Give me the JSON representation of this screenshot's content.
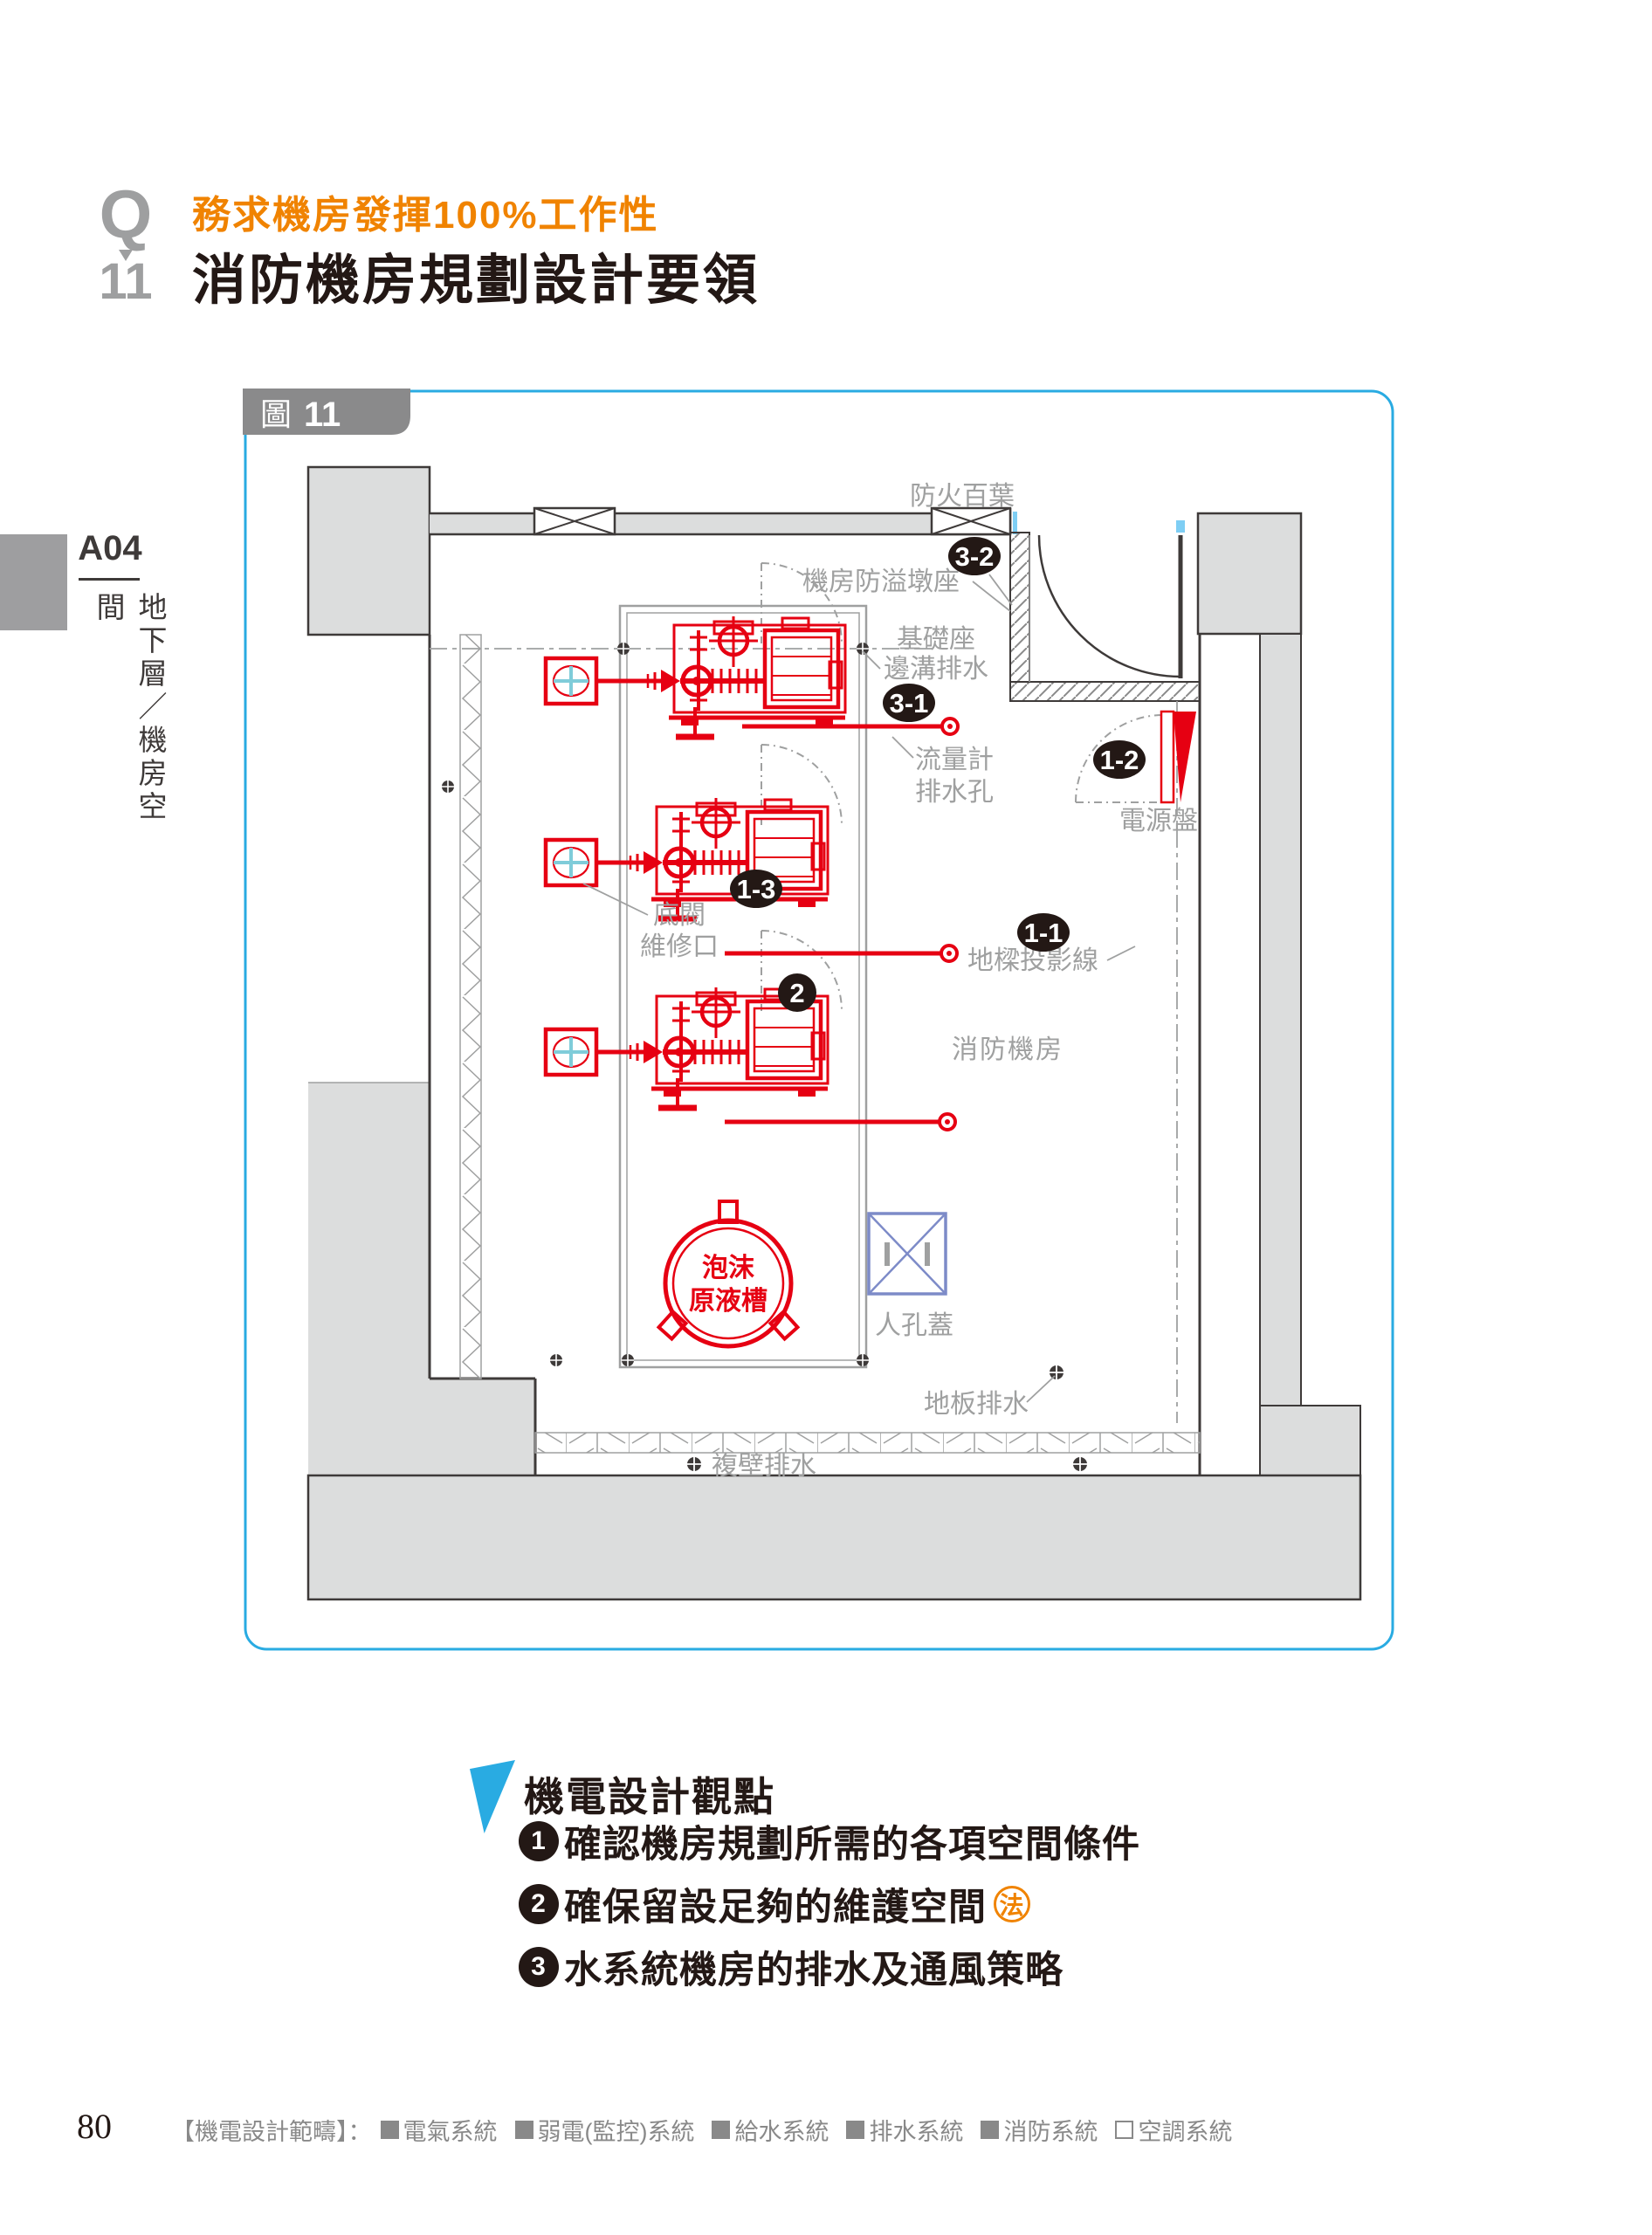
{
  "header": {
    "q_mark": "Q",
    "q_number": "11",
    "subtitle": "務求機房發揮100%工作性",
    "title": "消防機房規劃設計要領",
    "accent_orange": "#F08300"
  },
  "sidebar": {
    "code": "A04",
    "section": "地下層／機房空間"
  },
  "figure": {
    "tab_icon": "圖",
    "tab_number": "11",
    "border_color": "#29ABE2",
    "plan": {
      "labels": {
        "fire_louver": "防火百葉",
        "overflow_curb": "機房防溢墩座",
        "foundation1": "基礎座",
        "foundation2": "邊溝排水",
        "flow1": "流量計",
        "flow2": "排水孔",
        "power_panel": "電源盤",
        "beam_projection": "地樑投影線",
        "foot_valve1": "底閥",
        "foot_valve2": "維修口",
        "room_name": "消防機房",
        "tank1": "泡沫",
        "tank2": "原液槽",
        "manhole": "人孔蓋",
        "floor_drain": "地板排水",
        "wall_drain": "複壁排水"
      },
      "callouts": [
        "3-2",
        "3-1",
        "1-2",
        "1-3",
        "1-1",
        "2"
      ],
      "colors": {
        "equipment_red": "#E60012",
        "wall_dark": "#3E3A39",
        "fill_gray": "#DCDDDD",
        "label_gray": "#9FA0A0",
        "manhole_blue": "#7D8BC8",
        "valve_teal": "#7FCCD9"
      }
    }
  },
  "viewpoints": {
    "heading": "機電設計觀點",
    "law_mark": "法",
    "items": [
      {
        "num": "1",
        "text": "確認機房規劃所需的各項空間條件",
        "has_law_mark": false
      },
      {
        "num": "2",
        "text": "確保留設足夠的維護空間",
        "has_law_mark": true
      },
      {
        "num": "3",
        "text": "水系統機房的排水及通風策略",
        "has_law_mark": false
      }
    ]
  },
  "footer": {
    "page_number": "80",
    "scope_label": "【機電設計範疇】：",
    "systems": [
      {
        "name": "電氣系統",
        "filled": true
      },
      {
        "name": "弱電(監控)系統",
        "filled": true
      },
      {
        "name": "給水系統",
        "filled": true
      },
      {
        "name": "排水系統",
        "filled": true
      },
      {
        "name": "消防系統",
        "filled": true
      },
      {
        "name": "空調系統",
        "filled": false
      }
    ]
  }
}
